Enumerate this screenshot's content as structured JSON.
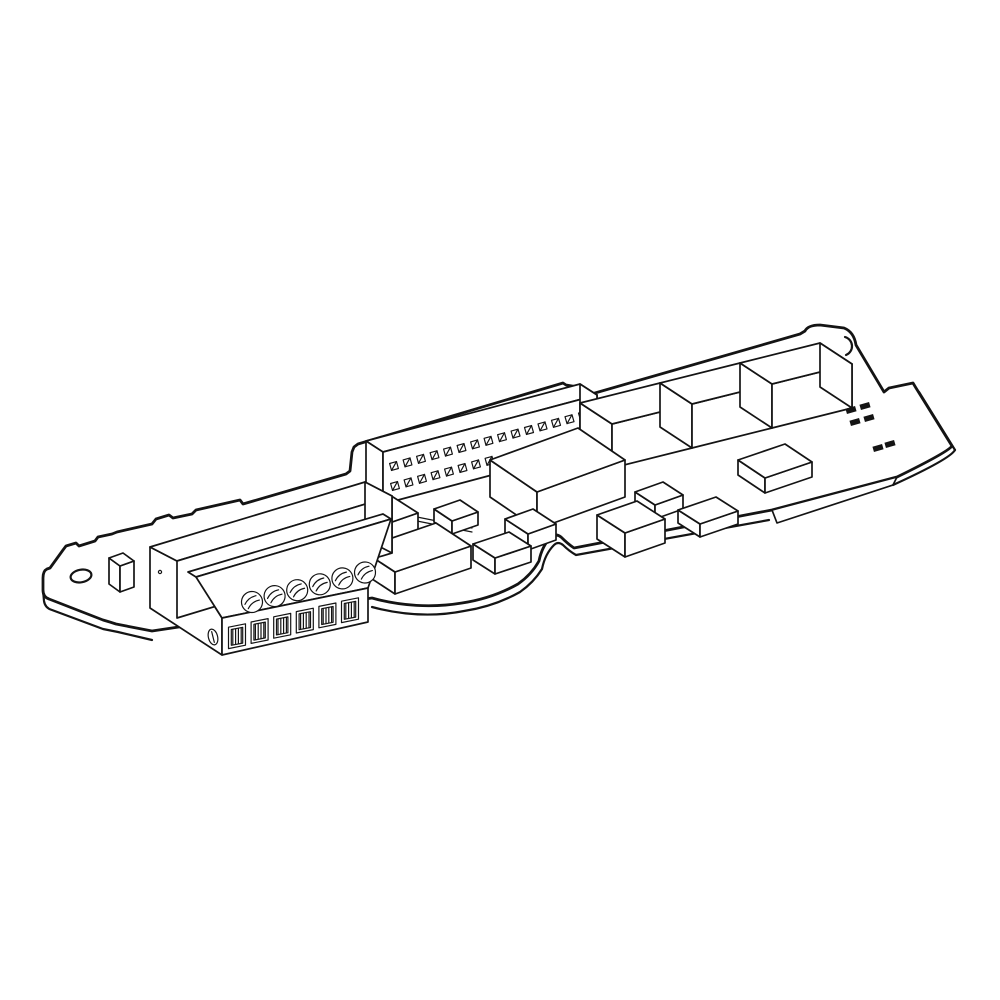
{
  "figure": {
    "type": "isometric-technical-line-drawing",
    "background": "#ffffff",
    "stroke_color": "#141414",
    "fill_color": "#ffffff",
    "summary": {
      "terminal_screws": 6,
      "wire_openings": 6,
      "pin_rows": 2,
      "visible_pins": 23,
      "large_relay_boxes": 3,
      "small_rect_components": 12,
      "smd_marks": 6,
      "mounting_holes": 2
    },
    "board": {
      "mounting_hole": {
        "cx": 81,
        "cy": 576,
        "rx": 10.5,
        "ry": 6.3,
        "rot": -10
      },
      "corner_hole_arc": {
        "d": "M 845,337 A 9.5,9.5 0 0 1 846,355"
      }
    },
    "pin_header": {
      "pin_half": 3.6,
      "pin_rot_offsets": [
        [
          4.45,
          2.47
        ],
        [
          -2.47,
          4.45
        ],
        [
          -4.45,
          -2.47
        ],
        [
          2.47,
          -4.45
        ]
      ],
      "rows": [
        {
          "name": "pin-row-top",
          "count": 15,
          "start": [
            394,
            466
          ],
          "step": [
            13.5,
            -3.6
          ]
        },
        {
          "name": "pin-row-bottom",
          "count": 8,
          "start": [
            395,
            486
          ],
          "step": [
            13.5,
            -3.6
          ]
        }
      ]
    },
    "terminal_block": {
      "screws": {
        "count": 6,
        "start": [
          252,
          602
        ],
        "step": [
          22.6,
          -5.9
        ],
        "r": 10.5,
        "slot_rot": -38
      },
      "openings": {
        "count": 6,
        "start": [
          237,
          635
        ],
        "step": [
          22.6,
          -5.2
        ],
        "half_w": 8.5,
        "tilt": -0.2,
        "top": -9.5,
        "bottom": 11.9
      },
      "side_screw": {
        "cx": 213,
        "cy": 637,
        "rx": 4.6,
        "ry": 8.0,
        "rot": -14
      },
      "housing_dot": {
        "cx": 160,
        "cy": 572,
        "r": 1.6
      }
    },
    "components": [
      {
        "name": "relay-box-1",
        "s": [
          612,
          424
        ],
        "e": [
          80,
          -20
        ],
        "w": [
          -32,
          -21
        ],
        "h": 44
      },
      {
        "name": "relay-box-2",
        "s": [
          692,
          404
        ],
        "e": [
          80,
          -20
        ],
        "w": [
          -32,
          -21
        ],
        "h": 44
      },
      {
        "name": "relay-box-3",
        "s": [
          772,
          384
        ],
        "e": [
          80,
          -20
        ],
        "w": [
          -32,
          -21
        ],
        "h": 44,
        "end": true
      },
      {
        "name": "flat-component-front-relays",
        "s": [
          765,
          478
        ],
        "e": [
          47,
          -16
        ],
        "w": [
          -27,
          -18
        ],
        "h": 15
      },
      {
        "name": "ic-chip-large",
        "s": [
          537,
          492
        ],
        "e": [
          88,
          -32
        ],
        "w": [
          -47,
          -32
        ],
        "h": 37
      },
      {
        "name": "component-g",
        "s": [
          655,
          505
        ],
        "e": [
          28,
          -10
        ],
        "w": [
          -20,
          -13
        ],
        "h": 14
      },
      {
        "name": "component-h",
        "s": [
          700,
          524
        ],
        "e": [
          38,
          -13
        ],
        "w": [
          -22,
          -14
        ],
        "h": 13
      },
      {
        "name": "component-f",
        "s": [
          625,
          533
        ],
        "e": [
          40,
          -14
        ],
        "w": [
          -28,
          -18
        ],
        "h": 24
      },
      {
        "name": "component-e",
        "s": [
          528,
          534
        ],
        "e": [
          28,
          -10
        ],
        "w": [
          -23,
          -15
        ],
        "h": 16
      },
      {
        "name": "component-i",
        "s": [
          495,
          558
        ],
        "e": [
          36,
          -12
        ],
        "w": [
          -22,
          -14
        ],
        "h": 16
      },
      {
        "name": "component-b",
        "s": [
          452,
          521
        ],
        "e": [
          26,
          -9
        ],
        "w": [
          -18,
          -12
        ],
        "h": 13
      },
      {
        "name": "component-a",
        "s": [
          375,
          528
        ],
        "e": [
          43,
          -15
        ],
        "w": [
          -25,
          -16
        ],
        "h": 17
      },
      {
        "name": "component-c",
        "s": [
          395,
          572
        ],
        "e": [
          76,
          -26
        ],
        "w": [
          -35,
          -23
        ],
        "h": 22
      },
      {
        "name": "component-back-small",
        "s": [
          318,
          527
        ],
        "e": [
          30,
          -11
        ],
        "w": [
          -18,
          -12
        ],
        "h": 13
      },
      {
        "name": "component-left-step",
        "s": [
          120,
          566
        ],
        "e": [
          14,
          -5
        ],
        "w": [
          -11,
          -8
        ],
        "h": 26
      }
    ],
    "smd_marks": {
      "rect_w": 10,
      "rect_h": 5.5,
      "rot": -16,
      "color": "#141414",
      "group1": [
        [
          851,
          410
        ],
        [
          865,
          406
        ],
        [
          855,
          422
        ],
        [
          869,
          418
        ]
      ],
      "group2": [
        [
          878,
          448
        ],
        [
          890,
          444
        ]
      ]
    },
    "traces": [
      {
        "d": "M 402,514 L 472,528"
      },
      {
        "d": "M 402,518 L 472,532"
      }
    ]
  }
}
